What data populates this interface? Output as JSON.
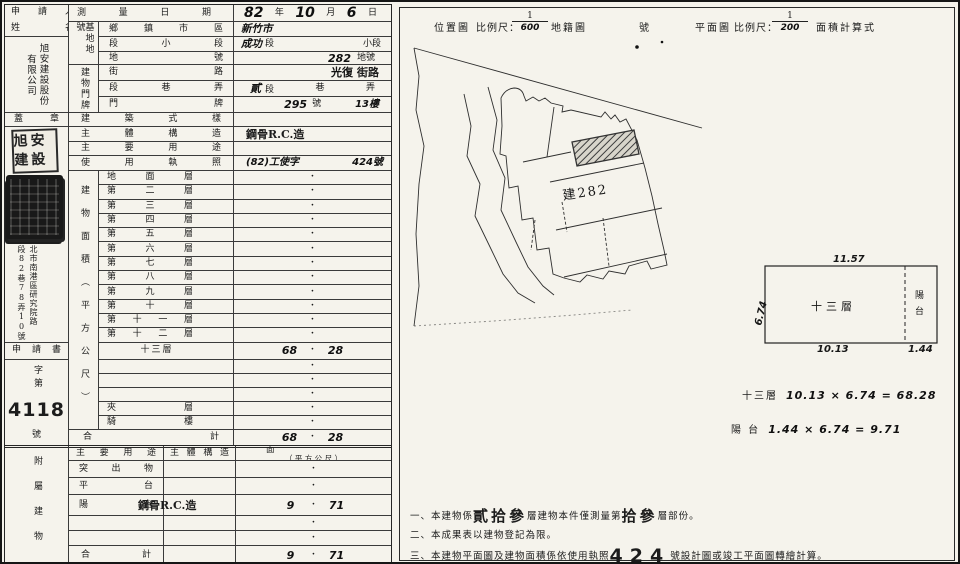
{
  "dot": "·",
  "lt": {
    "applicant": {
      "t1": "申 請 人",
      "t2": "姓 名",
      "co_r": "旭安建設股份",
      "co_l": "有限公司"
    },
    "date": {
      "label": "測 量 日 期",
      "y": "82",
      "yu": "年",
      "m": "10",
      "mu": "月",
      "d": "6",
      "du": "日"
    },
    "base": {
      "group": "基地地號",
      "district_label": "鄉 鎮 市 區",
      "district_hw": "新竹市",
      "sect_label": "段 小 段",
      "sect_hw": "成功",
      "sect_u1": "段",
      "sect_u2": "小段",
      "land_label": "地 號",
      "land_hw": "282",
      "land_u": "地號"
    },
    "door": {
      "group": "建物門牌",
      "street_label": "街 路",
      "street_hw": "光復",
      "street_u": "街路",
      "lane_label": "段 巷 弄",
      "lane_hw": "貳",
      "lane_u1": "段",
      "lane_u2": "巷",
      "lane_u3": "弄",
      "plate_label": "門 牌",
      "plate_no": "295",
      "plate_u": "號",
      "plate_fl": "13樓"
    },
    "stamp": {
      "label": "蓋 章",
      "seal1": "旭安建設",
      "addr_r": "北市南港區研究院路",
      "addr_l": "段82巷78弄10號一棟"
    },
    "style": {
      "label": "建 築 式 樣",
      "value": ""
    },
    "struct": {
      "label": "主 體 構 造",
      "value": "鋼骨R.C.造"
    },
    "use": {
      "label": "主 要 用 途",
      "value": ""
    },
    "lic": {
      "label": "使 用 執 照",
      "v1": "(82)工使字",
      "v2": "424號"
    },
    "farea": {
      "col": "建物面積（平方公尺）",
      "rows": [
        {
          "label": "地 面 層",
          "l": "",
          "r": ""
        },
        {
          "label": "第 二 層",
          "l": "",
          "r": ""
        },
        {
          "label": "第 三 層",
          "l": "",
          "r": ""
        },
        {
          "label": "第 四 層",
          "l": "",
          "r": ""
        },
        {
          "label": "第 五 層",
          "l": "",
          "r": ""
        },
        {
          "label": "第 六 層",
          "l": "",
          "r": ""
        },
        {
          "label": "第 七 層",
          "l": "",
          "r": ""
        },
        {
          "label": "第 八 層",
          "l": "",
          "r": ""
        },
        {
          "label": "第 九 層",
          "l": "",
          "r": ""
        },
        {
          "label": "第 十 層",
          "l": "",
          "r": ""
        },
        {
          "label": "第 十 一 層",
          "l": "",
          "r": ""
        },
        {
          "label": "第 十 二 層",
          "l": "",
          "r": ""
        },
        {
          "label": "十三層",
          "l": "68",
          "r": "28"
        },
        {
          "label": "",
          "l": "",
          "r": ""
        },
        {
          "label": "",
          "l": "",
          "r": ""
        },
        {
          "label": "",
          "l": "",
          "r": ""
        },
        {
          "label": "夾 層",
          "l": "",
          "r": ""
        },
        {
          "label": "騎 樓",
          "l": "",
          "r": ""
        }
      ],
      "total_label": "合 計",
      "tv1": "68",
      "tv2": "28"
    },
    "app": {
      "label": "申 請 書",
      "zidi": "字第",
      "num": "4118",
      "hao": "號"
    },
    "annex": {
      "col": "附屬建物",
      "h1": "主 要 用 途",
      "h2": "主 體 構 造",
      "h3a": "面 積",
      "h3b": "（ 平 方 公 尺 ）",
      "rows": [
        {
          "label": "突 出 物",
          "structure": "",
          "l": "",
          "r": ""
        },
        {
          "label": "平 台",
          "structure": "",
          "l": "",
          "r": ""
        },
        {
          "label": "陽 台",
          "structure": "鋼骨R.C.造",
          "l": "9",
          "r": "71"
        },
        {
          "label": "",
          "structure": "",
          "l": "",
          "r": ""
        },
        {
          "label": "",
          "structure": "",
          "l": "",
          "r": ""
        }
      ],
      "total_label": "合 計",
      "tv1": "9",
      "tv2": "71"
    }
  },
  "rp": {
    "h_loc": "位置圖",
    "h_scale1": "比例尺：",
    "f1n": "1",
    "f1d": "600",
    "h_cad": "地籍圖",
    "h_no": "號",
    "h_plan": "平面圖",
    "h_scale2": "比例尺：",
    "f2n": "1",
    "f2d": "200",
    "h_calc": "面積計算式",
    "plan_label": "建282",
    "fp": {
      "top": "11.57",
      "left": "6.74",
      "room": "十三層",
      "strip1": "陽",
      "strip2": "台",
      "b1": "10.13",
      "b2": "1.44"
    },
    "calc": {
      "n1": "十三層",
      "e1": "10.13 × 6.74 = 68.28",
      "n2": "陽 台",
      "e2": "1.44 × 6.74 = 9.71"
    },
    "notes": {
      "n1a": "一、本建物係",
      "n1b": "貳拾參",
      "n1c": "層建物本件僅測量第",
      "n1d": "拾參",
      "n1e": "層部份。",
      "n2": "二、本成果表以建物登記為限。",
      "n3a": "三、本建物平面圖及建物面積係依使用執照",
      "n3b": "424",
      "n3c": "號設計圖或竣工平面圖轉繪計算。"
    }
  }
}
